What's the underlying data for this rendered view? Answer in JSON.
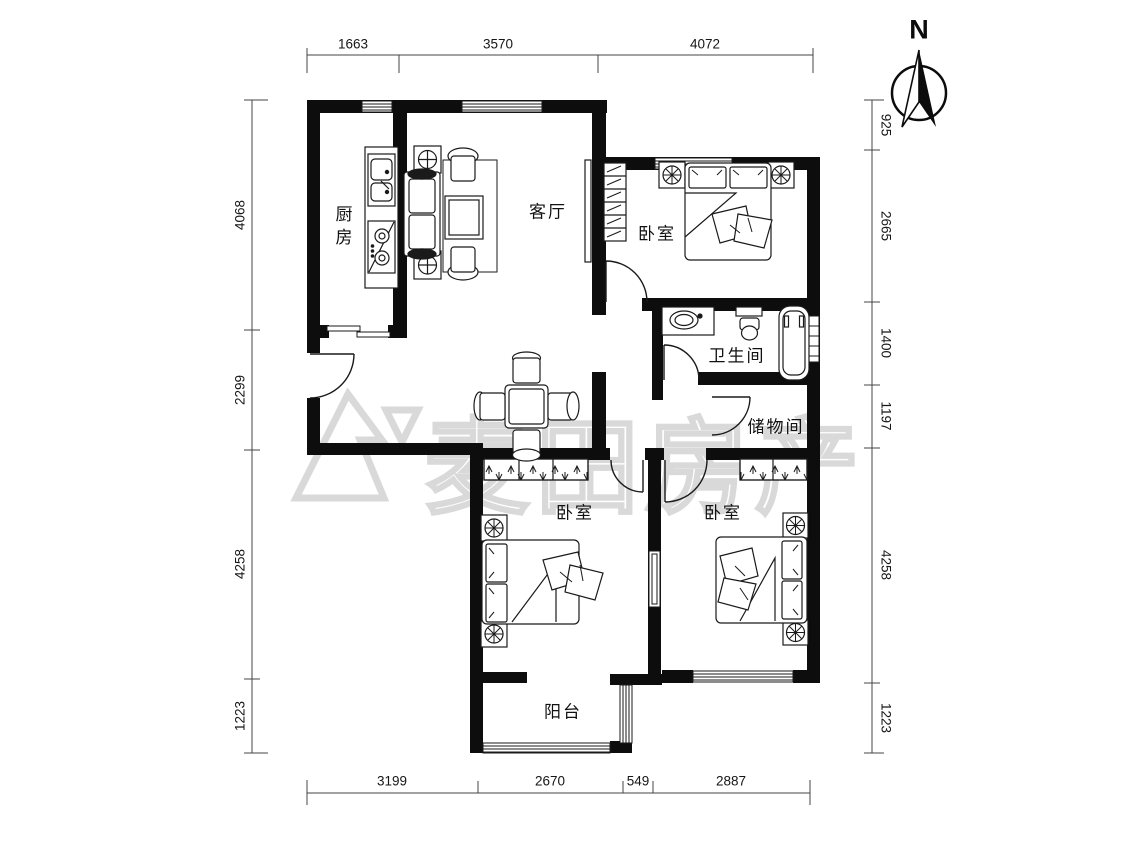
{
  "north": {
    "label": "N"
  },
  "watermark": {
    "text": "麦田房产"
  },
  "rooms": {
    "kitchen": {
      "label": "厨房"
    },
    "living": {
      "label": "客厅"
    },
    "bedroom_top": {
      "label": "卧室"
    },
    "bathroom": {
      "label": "卫生间"
    },
    "storage": {
      "label": "储物间"
    },
    "bedroom_left": {
      "label": "卧室"
    },
    "bedroom_right": {
      "label": "卧室"
    },
    "balcony": {
      "label": "阳台"
    }
  },
  "dimensions": {
    "top": [
      "1663",
      "3570",
      "4072"
    ],
    "bottom": [
      "3199",
      "2670",
      "549",
      "2887"
    ],
    "left": [
      "4068",
      "2299",
      "4258",
      "1223"
    ],
    "right": [
      "925",
      "2665",
      "1400",
      "1197",
      "4258",
      "1223"
    ]
  },
  "colors": {
    "wall": "#0d0d0d",
    "line": "#1a1a1a",
    "dim_text": "#161616",
    "watermark": "#d9d9d9"
  }
}
